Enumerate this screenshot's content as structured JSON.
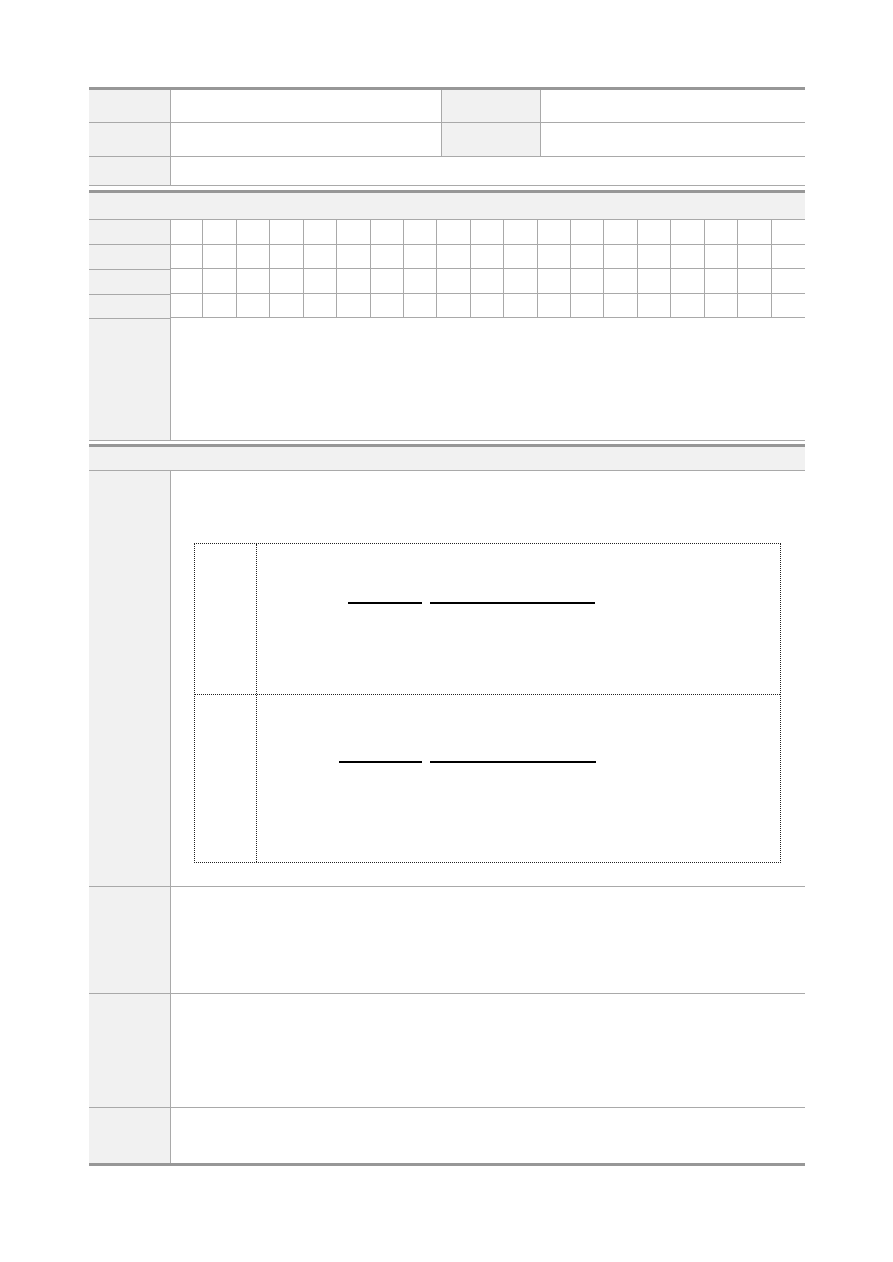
{
  "document": {
    "kind": "blank-form-template",
    "visible_text": "",
    "colors": {
      "page_bg": "#ffffff",
      "label_cell_fill": "#f1f1f1",
      "cell_border": "#a9a9a9",
      "section_rule": "#979797",
      "blank_line": "#000000",
      "dotted_border": "#222222"
    },
    "info_table": {
      "rows": [
        {
          "label1": "",
          "value1": "",
          "label2": "",
          "value2": ""
        },
        {
          "label1": "",
          "value1": "",
          "label2": "",
          "value2": ""
        },
        {
          "label": "",
          "value": ""
        }
      ]
    },
    "section1": {
      "header_label": "",
      "char_grid": {
        "columns": 19,
        "rows": 4,
        "row_labels": [
          "",
          "",
          "",
          ""
        ]
      },
      "tall_row": {
        "label": "",
        "content": ""
      }
    },
    "section2": {
      "header_label": "",
      "main_row": {
        "label": "",
        "dotted_box": {
          "rows": [
            {
              "side_label": "",
              "content": "",
              "blank_lines": [
                {
                  "width_px": 74
                },
                {
                  "width_px": 165
                }
              ]
            },
            {
              "side_label": "",
              "content": "",
              "blank_lines": [
                {
                  "width_px": 83
                },
                {
                  "width_px": 166
                }
              ]
            }
          ]
        }
      },
      "extra_rows": [
        {
          "label": "",
          "content": ""
        },
        {
          "label": "",
          "content": ""
        },
        {
          "label": "",
          "content": ""
        }
      ]
    }
  }
}
